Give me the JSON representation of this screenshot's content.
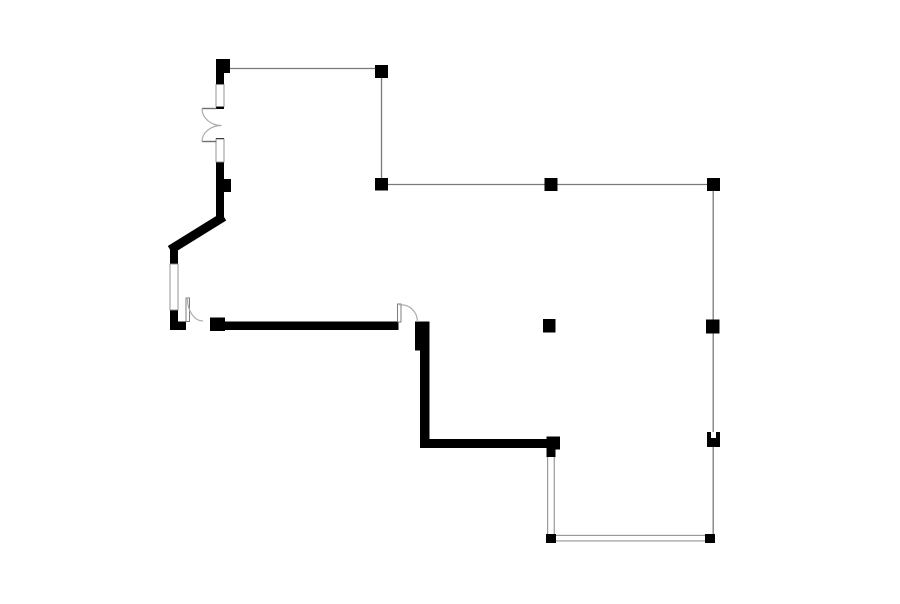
{
  "scene": {
    "type": "floor-plan",
    "width": 900,
    "height": 604,
    "background": "#ffffff"
  },
  "style": {
    "wall_color": "#000000",
    "column_color": "#000000",
    "grid_line_color": "#7a7a7a",
    "grid_line_width": 1.3,
    "glass_line_color": "#777777",
    "glass_line_width": 0.9,
    "frame_border_color": "#8a8a8a",
    "frame_fill": "#ffffff",
    "arc_color": "#ababab",
    "arc_width": 1.2,
    "leaf_border_color": "#6f6f6f",
    "leaf_fill": "#ffffff"
  },
  "grid_lines": [
    {
      "name": "grid-line-top-horizontal",
      "x1": 229,
      "y1": 68.5,
      "x2": 376,
      "y2": 68.5
    },
    {
      "name": "grid-line-upper-vertical",
      "x1": 381.5,
      "y1": 72,
      "x2": 381.5,
      "y2": 184
    },
    {
      "name": "grid-line-mid-horizontal",
      "x1": 381.5,
      "y1": 184.5,
      "x2": 713.2,
      "y2": 184.5
    },
    {
      "name": "grid-line-right-vertical",
      "x1": 713.2,
      "y1": 184.5,
      "x2": 713.2,
      "y2": 538
    }
  ],
  "glass_walls": [
    {
      "name": "glass-wall-vertical",
      "x": 547.2,
      "y": 456.5,
      "w": 7.5,
      "h": 78,
      "orientation": "vertical"
    },
    {
      "name": "glass-wall-horizontal",
      "x": 556,
      "y": 534.8,
      "w": 149,
      "h": 6.6,
      "orientation": "horizontal"
    }
  ],
  "walls": [
    {
      "name": "wall-top-left-stub",
      "x": 216,
      "y": 71,
      "w": 8,
      "h": 15
    },
    {
      "name": "wall-jamb-tick-upper",
      "x": 216,
      "y": 106,
      "w": 8,
      "h": 3
    },
    {
      "name": "wall-jamb-tick-lower",
      "x": 216,
      "y": 138,
      "w": 8,
      "h": 3
    },
    {
      "name": "wall-left-vertical-upper",
      "x": 216,
      "y": 161,
      "w": 8,
      "h": 61
    },
    {
      "name": "wall-left-vertical-mid",
      "x": 170,
      "y": 245,
      "w": 8,
      "h": 20
    },
    {
      "name": "wall-left-vertical-lower",
      "x": 170,
      "y": 309,
      "w": 8,
      "h": 21
    },
    {
      "name": "wall-bottom-left-corner",
      "x": 170,
      "y": 321.5,
      "w": 16,
      "h": 8.5
    },
    {
      "name": "wall-main-horizontal",
      "x": 225,
      "y": 321.5,
      "w": 173.5,
      "h": 8.5
    },
    {
      "name": "wall-right-vertical",
      "x": 420,
      "y": 321.5,
      "w": 9.5,
      "h": 126.5
    },
    {
      "name": "wall-bottom-horizontal",
      "x": 420,
      "y": 439,
      "w": 127,
      "h": 9
    }
  ],
  "diagonal_walls": [
    {
      "name": "wall-diagonal",
      "x1": 220,
      "y1": 219,
      "x2": 174,
      "y2": 247.5,
      "width": 9
    }
  ],
  "frames": [
    {
      "name": "door-jamb-upper",
      "x": 216,
      "y": 84.5,
      "w": 8,
      "h": 22
    },
    {
      "name": "door-jamb-lower",
      "x": 216,
      "y": 139,
      "w": 8,
      "h": 23
    },
    {
      "name": "window-left",
      "x": 170,
      "y": 264,
      "w": 8,
      "h": 46
    }
  ],
  "columns": [
    {
      "name": "column-top-left",
      "x": 216,
      "y": 59,
      "w": 14,
      "h": 14
    },
    {
      "name": "column-top-right",
      "x": 375,
      "y": 65,
      "w": 13,
      "h": 13
    },
    {
      "name": "column-grid-left",
      "x": 375,
      "y": 178,
      "w": 13,
      "h": 12.5
    },
    {
      "name": "column-grid-mid-top",
      "x": 544.5,
      "y": 178,
      "w": 13,
      "h": 13
    },
    {
      "name": "column-grid-right-top",
      "x": 707,
      "y": 178,
      "w": 13,
      "h": 13
    },
    {
      "name": "column-interior",
      "x": 543,
      "y": 319,
      "w": 12.5,
      "h": 13.5
    },
    {
      "name": "column-grid-right-mid",
      "x": 706,
      "y": 319.5,
      "w": 13.5,
      "h": 14
    },
    {
      "name": "column-grid-right-lower",
      "x": 707,
      "y": 432,
      "w": 13,
      "h": 15
    },
    {
      "name": "column-corner-bottom-right",
      "x": 705,
      "y": 534,
      "w": 10,
      "h": 9
    },
    {
      "name": "column-glass-corner",
      "x": 546,
      "y": 534,
      "w": 10,
      "h": 9
    },
    {
      "name": "column-wall-end",
      "x": 546.5,
      "y": 436.5,
      "w": 13.5,
      "h": 13
    },
    {
      "name": "column-wall-end-lower",
      "x": 546.5,
      "y": 449,
      "w": 9,
      "h": 8
    },
    {
      "name": "column-door-left",
      "x": 210,
      "y": 317.5,
      "w": 15,
      "h": 13.5
    },
    {
      "name": "column-wall-bump",
      "x": 222,
      "y": 179,
      "w": 9,
      "h": 13
    },
    {
      "name": "column-main-corner",
      "x": 415,
      "y": 321.5,
      "w": 14,
      "h": 29
    }
  ],
  "column_notches": [
    {
      "name": "column-notch",
      "x": 711,
      "y": 432,
      "w": 5,
      "h": 6
    }
  ],
  "door_leaves": [
    {
      "name": "door-leaf-double-upper",
      "type": "line",
      "x1": 202,
      "y1": 108.5,
      "x2": 216.5,
      "y2": 108.5
    },
    {
      "name": "door-leaf-double-lower",
      "type": "line",
      "x1": 202,
      "y1": 141.5,
      "x2": 216.5,
      "y2": 141.5
    },
    {
      "name": "door-leaf-left",
      "type": "rect",
      "x": 186,
      "y": 298,
      "w": 3.5,
      "h": 23.5
    },
    {
      "name": "door-leaf-right",
      "type": "rect",
      "x": 397.5,
      "y": 304,
      "w": 3.5,
      "h": 18
    }
  ],
  "door_arcs": [
    {
      "name": "door-swing-arc-double-upper",
      "d": "M 202 108.5 A 19.5 17 0 0 0 221.5 125.5"
    },
    {
      "name": "door-swing-arc-double-lower",
      "d": "M 202 141.5 A 19.5 16 0 0 1 221.5 125.5"
    },
    {
      "name": "door-swing-arc-left",
      "d": "M 187.5 299 A 15.5 22 0 0 0 203 321"
    },
    {
      "name": "door-swing-arc-right",
      "d": "M 399.5 305 A 16 17 0 0 1 417.5 322"
    }
  ]
}
